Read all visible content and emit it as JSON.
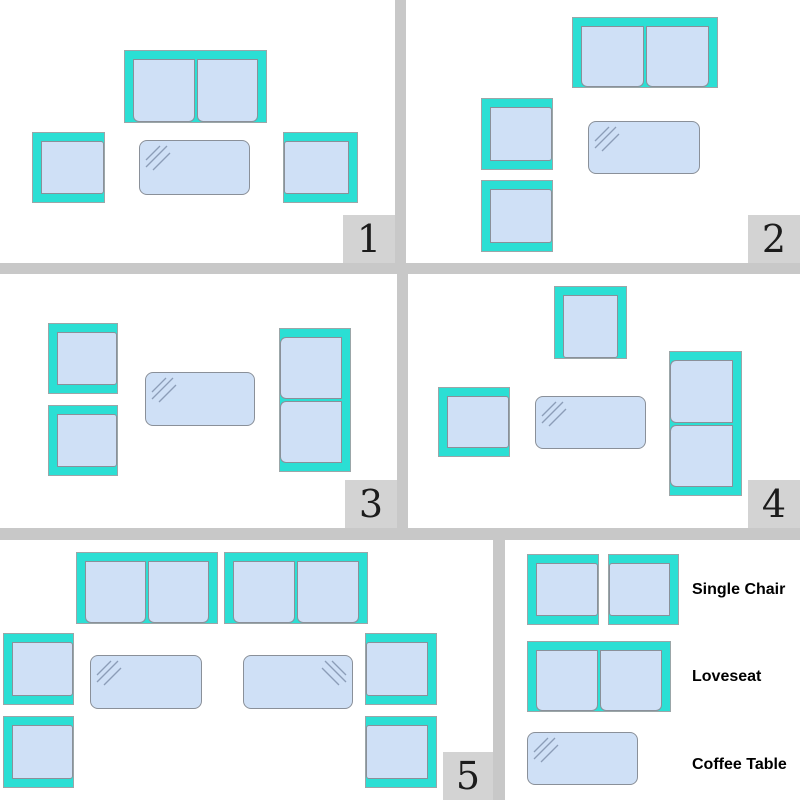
{
  "title": "Patio furniture arrangement layout options",
  "colors": {
    "background": "#C8C8C8",
    "panel_bg": "#FFFFFF",
    "teal": "#2BDFD4",
    "seat_fill": "#CFE0F6",
    "seat_outline": "#8A9099",
    "shine": "#8C9DB8",
    "badge_bg": "#D3D3D3",
    "badge_text": "#1C1C1C",
    "label_text": "#000000"
  },
  "layouts": [
    {
      "number": "1",
      "furniture": [
        {
          "type": "loveseat",
          "facing": "down",
          "position": "top-center"
        },
        {
          "type": "single-chair",
          "facing": "right",
          "position": "left"
        },
        {
          "type": "coffee-table",
          "position": "center"
        },
        {
          "type": "single-chair",
          "facing": "left",
          "position": "right"
        }
      ]
    },
    {
      "number": "2",
      "furniture": [
        {
          "type": "loveseat",
          "facing": "down",
          "position": "top-right"
        },
        {
          "type": "single-chair",
          "facing": "right",
          "position": "left-upper"
        },
        {
          "type": "single-chair",
          "facing": "right",
          "position": "left-lower"
        },
        {
          "type": "coffee-table",
          "position": "center-right"
        }
      ]
    },
    {
      "number": "3",
      "furniture": [
        {
          "type": "single-chair",
          "facing": "right",
          "position": "left-upper"
        },
        {
          "type": "single-chair",
          "facing": "right",
          "position": "left-lower"
        },
        {
          "type": "coffee-table",
          "position": "center"
        },
        {
          "type": "loveseat",
          "facing": "left",
          "position": "right"
        }
      ]
    },
    {
      "number": "4",
      "furniture": [
        {
          "type": "single-chair",
          "facing": "down",
          "position": "top-center"
        },
        {
          "type": "single-chair",
          "facing": "right",
          "position": "left"
        },
        {
          "type": "coffee-table",
          "position": "center"
        },
        {
          "type": "loveseat",
          "facing": "left",
          "position": "right"
        }
      ]
    },
    {
      "number": "5",
      "furniture": [
        {
          "type": "loveseat",
          "facing": "down",
          "position": "top-left"
        },
        {
          "type": "loveseat",
          "facing": "down",
          "position": "top-right"
        },
        {
          "type": "single-chair",
          "facing": "right",
          "position": "left-upper"
        },
        {
          "type": "single-chair",
          "facing": "right",
          "position": "left-lower"
        },
        {
          "type": "coffee-table",
          "position": "center-left"
        },
        {
          "type": "coffee-table",
          "position": "center-right"
        },
        {
          "type": "single-chair",
          "facing": "left",
          "position": "right-upper"
        },
        {
          "type": "single-chair",
          "facing": "left",
          "position": "right-lower"
        }
      ]
    }
  ],
  "legend": {
    "items": [
      {
        "label": "Single Chair"
      },
      {
        "label": "Loveseat"
      },
      {
        "label": "Coffee Table"
      }
    ]
  }
}
